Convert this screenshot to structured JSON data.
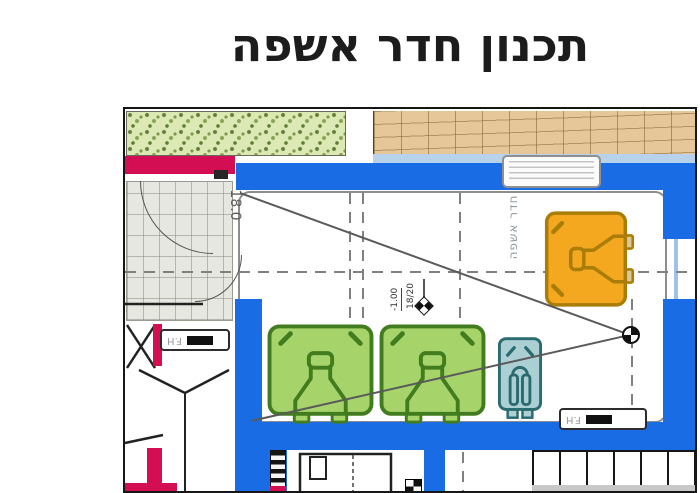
{
  "slide": {
    "title": "תכנון חדר אשפה"
  },
  "plan": {
    "room_label": "חדר אשפה",
    "entrance_dim": "18.0",
    "level_marker": {
      "value": "-1.00",
      "fraction": "18/20"
    },
    "fire_hose_left": "F.H",
    "fire_hose_right": "F.H",
    "colors": {
      "wall_blue": "#1a6ce4",
      "curb_crimson": "#d40e52",
      "bin_green": "#a6d46a",
      "bin_green_outline": "#417c1e",
      "bin_orange": "#f3a820",
      "bin_orange_outline": "#aa7d08",
      "bin_teal": "#accfd3",
      "bin_teal_outline": "#2a6b70",
      "vegetation": "#dce9b4",
      "pavement_tan": "#e5c79a",
      "paving_gray": "#e7e7e1"
    },
    "bins": [
      {
        "name": "wheelie-bin-green-1",
        "fill": "#a6d46a"
      },
      {
        "name": "wheelie-bin-green-2",
        "fill": "#a6d46a"
      },
      {
        "name": "small-bin-teal",
        "fill": "#accfd3"
      },
      {
        "name": "wheelie-bin-orange",
        "fill": "#f3a820"
      }
    ],
    "icons": {
      "floor_drain": "quartered-circle",
      "level_marker": "quartered-diamond"
    }
  }
}
